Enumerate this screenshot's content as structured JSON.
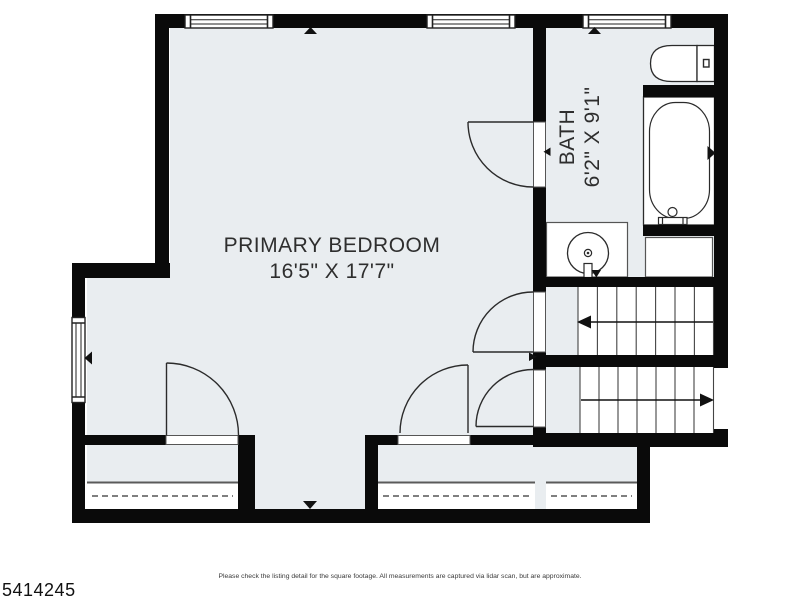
{
  "colors": {
    "wall": "#0a0a0a",
    "floor": "#e9edf0",
    "fixture_line": "#2b2b2b",
    "text": "#2e2e2e"
  },
  "rooms": {
    "primary_bedroom": {
      "name": "PRIMARY BEDROOM",
      "dimensions": "16'5\" X 17'7\""
    },
    "bath": {
      "name": "BATH",
      "dimensions": "6'2\" X 9'1\""
    }
  },
  "fixtures": [
    "toilet",
    "bathtub",
    "sink-vanity",
    "counter",
    "staircase-up",
    "staircase-down",
    "closet-left",
    "closet-middle",
    "closet-right"
  ],
  "footer": {
    "listing_id": "5414245",
    "disclaimer": "Please check the listing detail for the square footage. All measurements are captured via lidar scan, but are approximate."
  }
}
